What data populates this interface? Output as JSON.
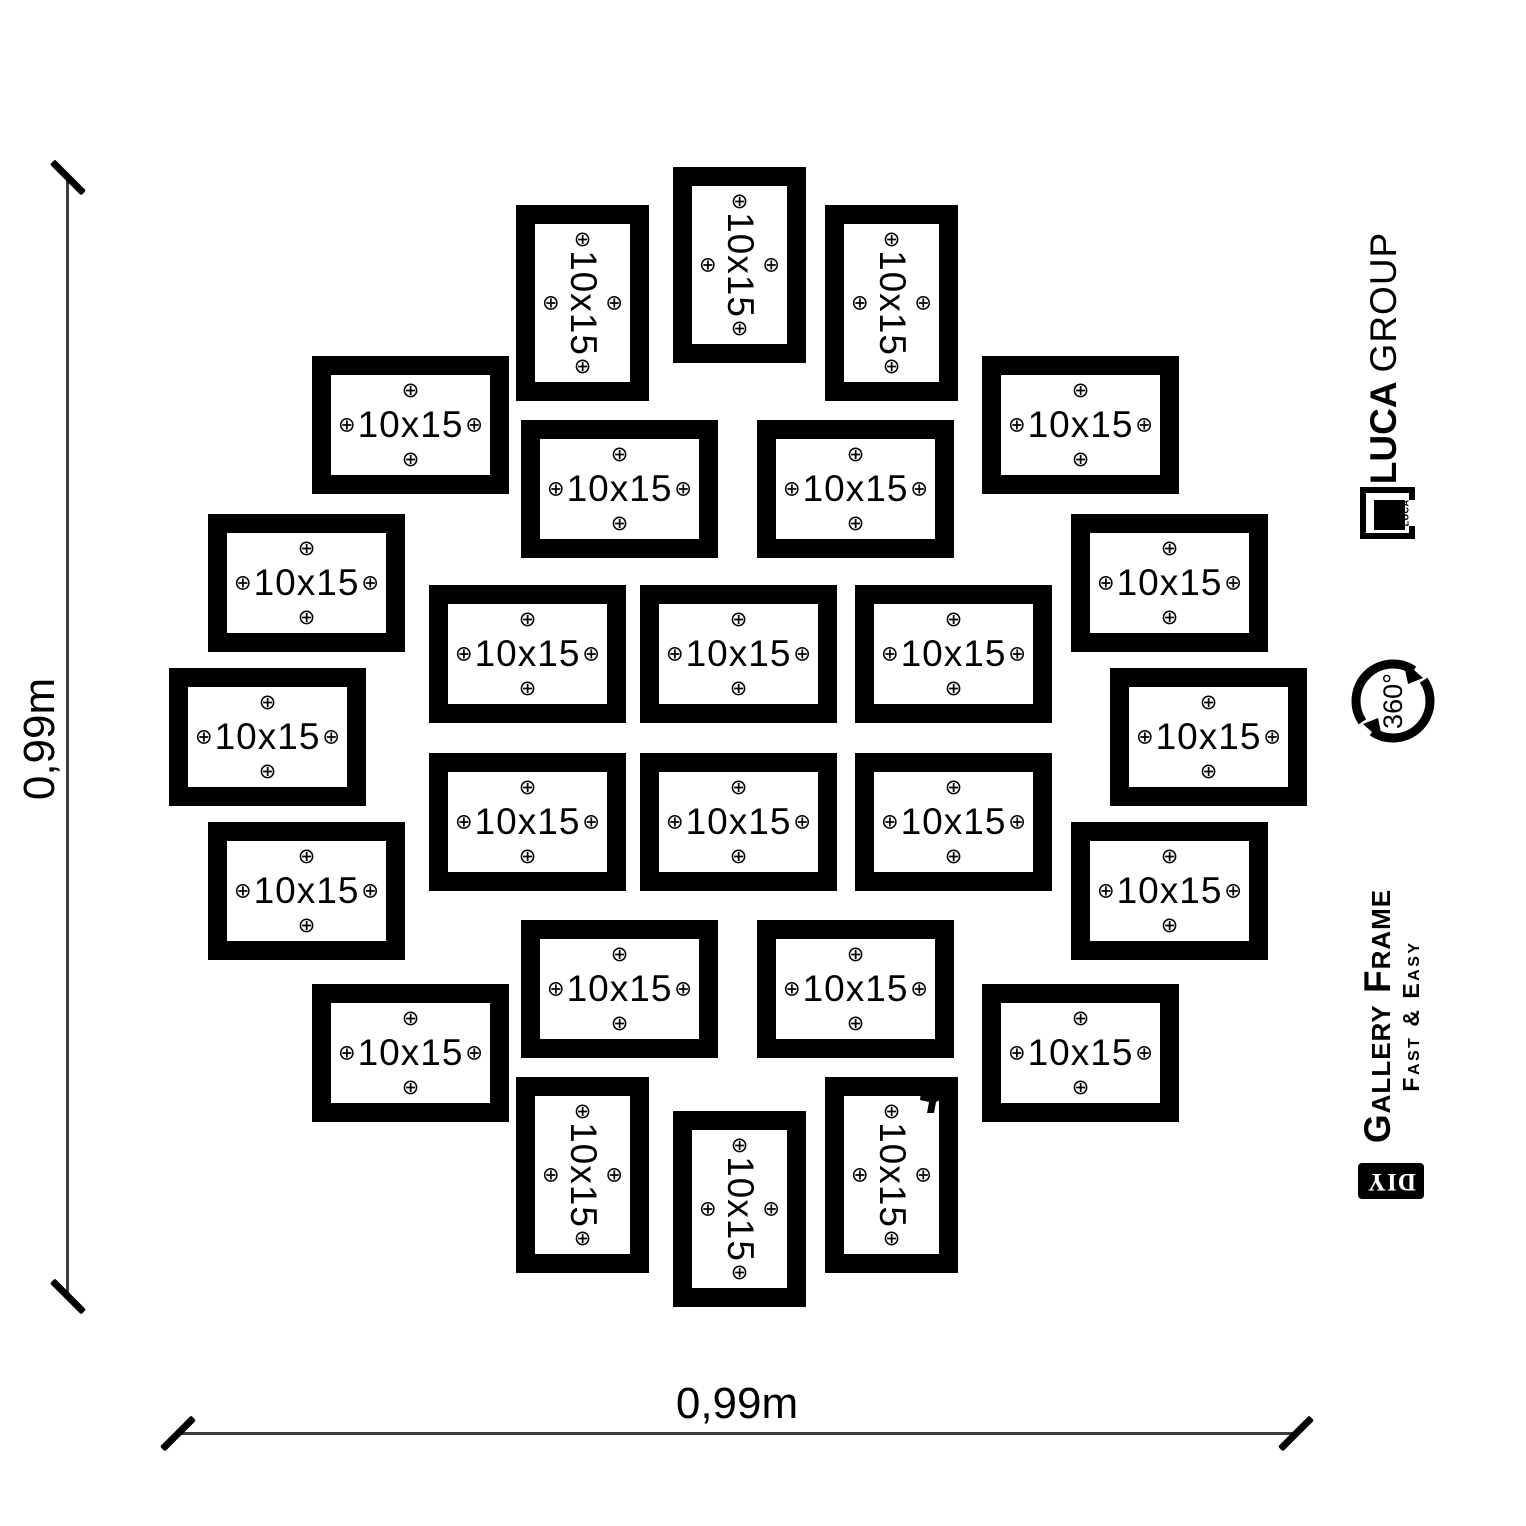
{
  "canvas": {
    "width": 1526,
    "height": 1526,
    "background": "#ffffff"
  },
  "frames": {
    "label": "10x15",
    "mark_glyph": "⊕",
    "frame_color": "#000000",
    "landscape_size": {
      "w": 197,
      "h": 138
    },
    "portrait_size": {
      "w": 133,
      "h": 196
    },
    "items": [
      {
        "x": 516,
        "y": 205,
        "o": "v"
      },
      {
        "x": 673,
        "y": 167,
        "o": "v"
      },
      {
        "x": 825,
        "y": 205,
        "o": "v"
      },
      {
        "x": 312,
        "y": 356,
        "o": "h"
      },
      {
        "x": 521,
        "y": 420,
        "o": "h"
      },
      {
        "x": 757,
        "y": 420,
        "o": "h"
      },
      {
        "x": 982,
        "y": 356,
        "o": "h"
      },
      {
        "x": 208,
        "y": 514,
        "o": "h"
      },
      {
        "x": 1071,
        "y": 514,
        "o": "h"
      },
      {
        "x": 169,
        "y": 668,
        "o": "h"
      },
      {
        "x": 429,
        "y": 585,
        "o": "h"
      },
      {
        "x": 640,
        "y": 585,
        "o": "h"
      },
      {
        "x": 855,
        "y": 585,
        "o": "h"
      },
      {
        "x": 1110,
        "y": 668,
        "o": "h"
      },
      {
        "x": 429,
        "y": 753,
        "o": "h"
      },
      {
        "x": 640,
        "y": 753,
        "o": "h"
      },
      {
        "x": 855,
        "y": 753,
        "o": "h"
      },
      {
        "x": 208,
        "y": 822,
        "o": "h"
      },
      {
        "x": 1071,
        "y": 822,
        "o": "h"
      },
      {
        "x": 312,
        "y": 984,
        "o": "h"
      },
      {
        "x": 521,
        "y": 920,
        "o": "h"
      },
      {
        "x": 757,
        "y": 920,
        "o": "h"
      },
      {
        "x": 982,
        "y": 984,
        "o": "h"
      },
      {
        "x": 516,
        "y": 1077,
        "o": "v"
      },
      {
        "x": 673,
        "y": 1111,
        "o": "v"
      },
      {
        "x": 825,
        "y": 1077,
        "o": "v"
      }
    ]
  },
  "dimensions": {
    "left": {
      "label": "0,99m"
    },
    "bottom": {
      "label": "0,99m"
    },
    "line_color": "#3c3c3c",
    "tick_color": "#000000"
  },
  "sidebar": {
    "brand": {
      "bold": "LUCA",
      "light": "GROUP"
    },
    "logo_caption": "LUCA",
    "rotation_label": "360°",
    "title": "Gallery Frame",
    "subtitle": "Fast & Easy",
    "diy": "DIY"
  }
}
